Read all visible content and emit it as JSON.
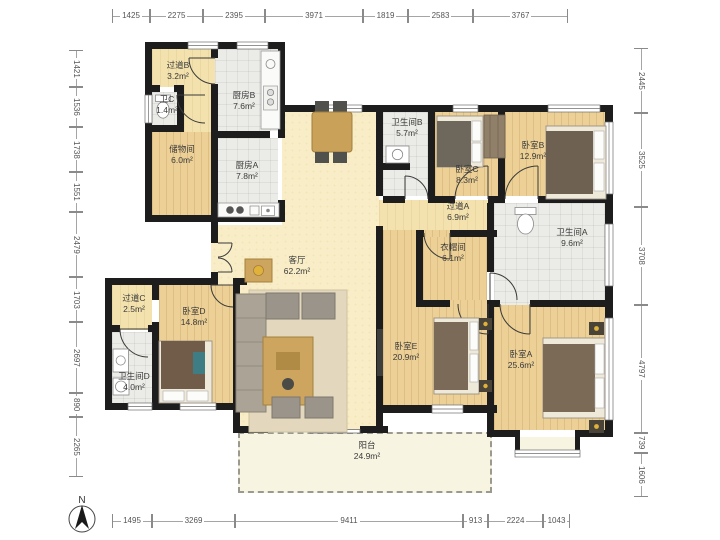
{
  "compass": {
    "label": "N"
  },
  "rulers": {
    "top": {
      "orientation": "h",
      "line_pos": 16,
      "ticks": [
        112,
        150,
        203,
        265,
        363,
        408,
        473,
        568
      ],
      "labels": [
        "1425",
        "2275",
        "2395",
        "3971",
        "1819",
        "2583",
        "3767"
      ]
    },
    "bottom": {
      "orientation": "h",
      "line_pos": 521,
      "ticks": [
        112,
        152,
        235,
        463,
        488,
        543,
        570
      ],
      "labels": [
        "1495",
        "3269",
        "9411",
        "913",
        "2224",
        "1043"
      ]
    },
    "left": {
      "orientation": "v",
      "line_pos": 76,
      "ticks": [
        50,
        87,
        127,
        172,
        212,
        277,
        322,
        393,
        417,
        477
      ],
      "labels": [
        "1421",
        "1536",
        "1738",
        "1551",
        "2479",
        "1703",
        "2697",
        "890",
        "2265"
      ]
    },
    "right": {
      "orientation": "v",
      "line_pos": 641,
      "ticks": [
        48,
        113,
        207,
        305,
        433,
        453,
        497
      ],
      "labels": [
        "2445",
        "3525",
        "3708",
        "4797",
        "739",
        "1606"
      ]
    }
  },
  "rooms": [
    {
      "id": "hallway-b",
      "name": "过道B",
      "area": "3.2m²",
      "floor": "wood-light",
      "rect": [
        152,
        49,
        63,
        38
      ],
      "label": [
        178,
        60
      ]
    },
    {
      "id": "corridor",
      "name": "",
      "area": "",
      "floor": "wood-light",
      "rect": [
        184,
        87,
        27,
        45
      ],
      "label": null
    },
    {
      "id": "toilet-c",
      "name": "卫C",
      "area": "1.4m²",
      "floor": "tile",
      "rect": [
        152,
        92,
        25,
        33
      ],
      "label": [
        167,
        94
      ]
    },
    {
      "id": "kitchen-b",
      "name": "厨房B",
      "area": "7.6m²",
      "floor": "tile",
      "rect": [
        215,
        49,
        63,
        82
      ],
      "label": [
        244,
        90
      ]
    },
    {
      "id": "storage",
      "name": "储物间",
      "area": "6.0m²",
      "floor": "wood",
      "rect": [
        152,
        132,
        59,
        83
      ],
      "label": [
        182,
        144
      ]
    },
    {
      "id": "kitchen-a",
      "name": "厨房A",
      "area": "7.8m²",
      "floor": "tile",
      "rect": [
        215,
        138,
        63,
        80
      ],
      "label": [
        247,
        160
      ]
    },
    {
      "id": "living-a",
      "name": "客厅",
      "area": "62.2m²",
      "floor": "living",
      "rect": [
        282,
        112,
        97,
        318
      ],
      "label": [
        297,
        255
      ]
    },
    {
      "id": "living-b",
      "name": "",
      "area": "",
      "floor": "living",
      "rect": [
        211,
        225,
        71,
        60
      ],
      "label": null
    },
    {
      "id": "living-c",
      "name": "",
      "area": "",
      "floor": "living",
      "rect": [
        240,
        285,
        42,
        145
      ],
      "label": null
    },
    {
      "id": "bath-b",
      "name": "卫生间B",
      "area": "5.7m²",
      "floor": "tile",
      "rect": [
        383,
        112,
        45,
        84
      ],
      "label": [
        407,
        117
      ]
    },
    {
      "id": "bedroom-c",
      "name": "卧室C",
      "area": "8.3m²",
      "floor": "wood",
      "rect": [
        435,
        112,
        63,
        84
      ],
      "label": [
        467,
        164
      ]
    },
    {
      "id": "bedroom-b",
      "name": "卧室B",
      "area": "12.9m²",
      "floor": "wood",
      "rect": [
        505,
        112,
        100,
        84
      ],
      "label": [
        533,
        140
      ]
    },
    {
      "id": "hallway-a",
      "name": "过道A",
      "area": "6.9m²",
      "floor": "wood-light",
      "rect": [
        379,
        200,
        115,
        30
      ],
      "label": [
        458,
        201
      ]
    },
    {
      "id": "bedroom-e",
      "name": "卧室E",
      "area": "20.9m²",
      "floor": "wood",
      "rect": [
        383,
        230,
        104,
        175
      ],
      "label": [
        406,
        341
      ]
    },
    {
      "id": "cloakroom",
      "name": "衣帽间",
      "area": "6.1m²",
      "floor": "wood",
      "rect": [
        423,
        237,
        64,
        63
      ],
      "label": [
        453,
        242
      ]
    },
    {
      "id": "bath-a",
      "name": "卫生间A",
      "area": "9.6m²",
      "floor": "tile",
      "rect": [
        494,
        203,
        111,
        102
      ],
      "label": [
        572,
        227
      ]
    },
    {
      "id": "hallway-c",
      "name": "过道C",
      "area": "2.5m²",
      "floor": "wood-light",
      "rect": [
        112,
        285,
        40,
        45
      ],
      "label": [
        134,
        293
      ]
    },
    {
      "id": "bedroom-d",
      "name": "卧室D",
      "area": "14.8m²",
      "floor": "wood",
      "rect": [
        159,
        285,
        74,
        118
      ],
      "label": [
        194,
        306
      ]
    },
    {
      "id": "bath-d",
      "name": "卫生间D",
      "area": "4.0m²",
      "floor": "tile",
      "rect": [
        112,
        332,
        40,
        71
      ],
      "label": [
        134,
        371
      ]
    },
    {
      "id": "bedroom-a",
      "name": "卧室A",
      "area": "25.6m²",
      "floor": "wood",
      "rect": [
        494,
        305,
        111,
        125
      ],
      "label": [
        521,
        349
      ]
    },
    {
      "id": "bay-window",
      "name": "",
      "area": "",
      "floor": "balcony",
      "rect": [
        517,
        437,
        61,
        18
      ],
      "label": null
    },
    {
      "id": "balcony",
      "name": "阳台",
      "area": "24.9m²",
      "floor": "balcony",
      "rect": [
        238,
        432,
        254,
        61
      ],
      "label": [
        367,
        440
      ],
      "dashed": true
    }
  ]
}
